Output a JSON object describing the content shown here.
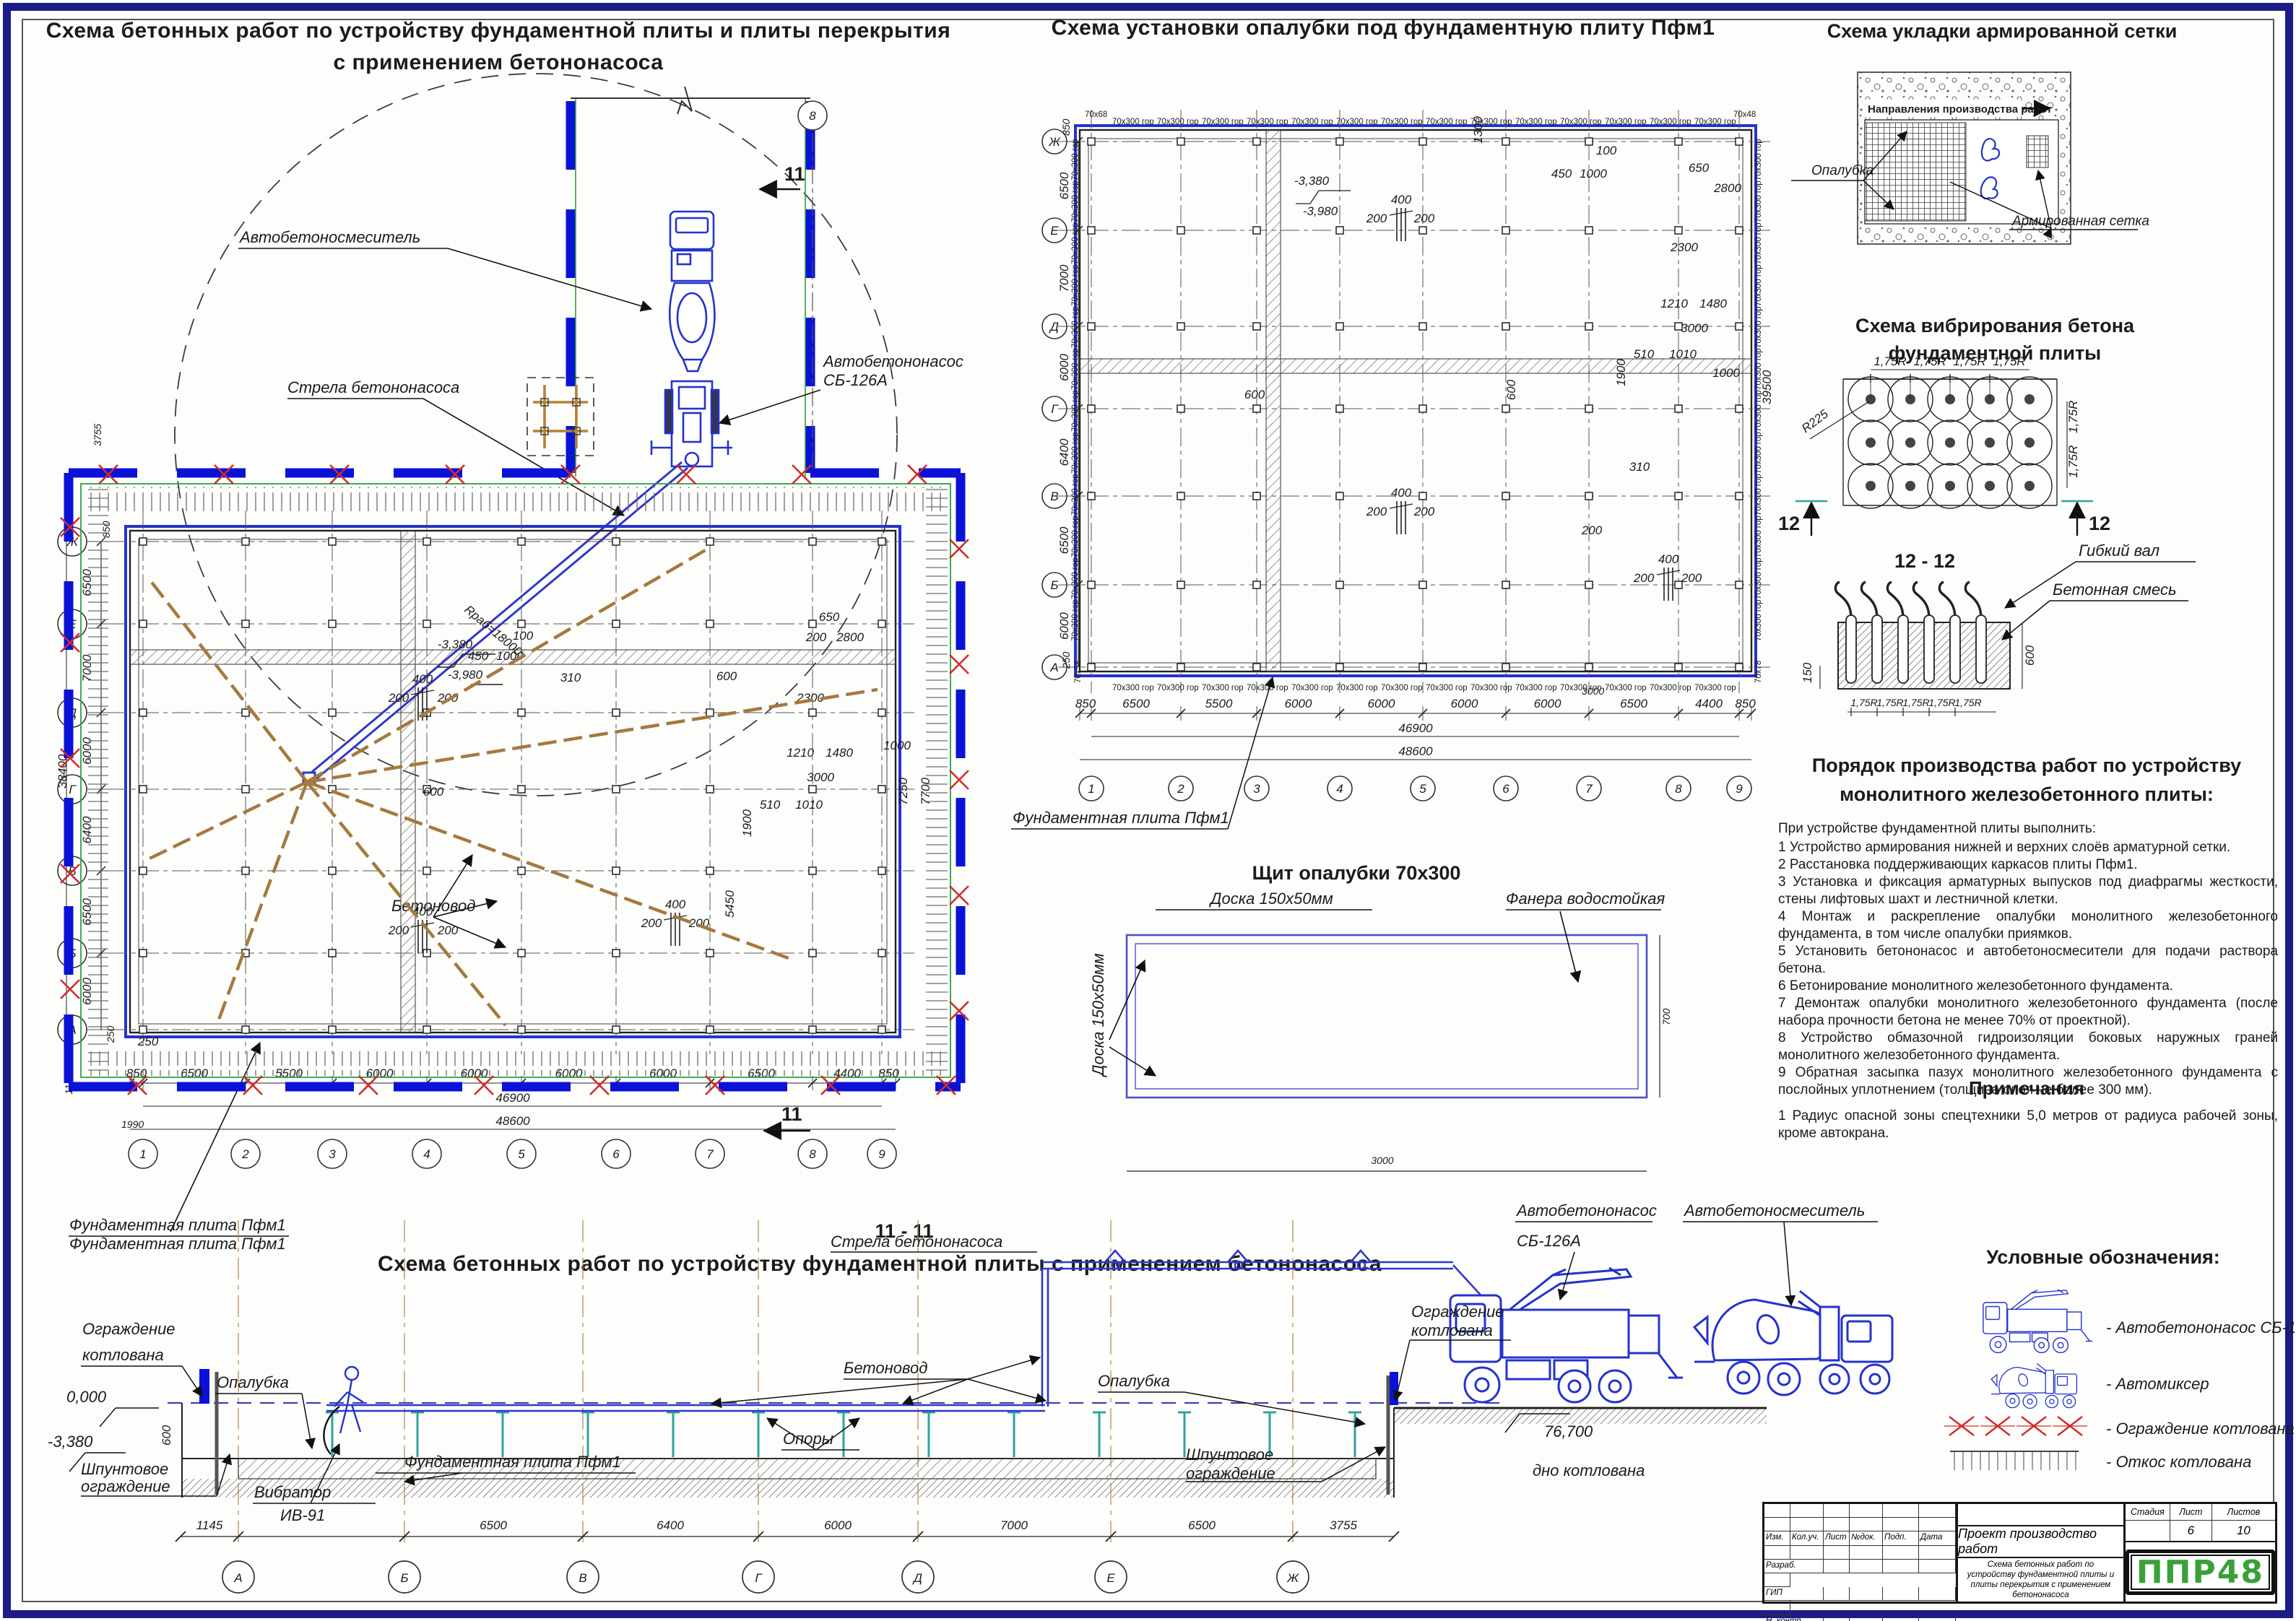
{
  "colors": {
    "cad_blue": "#2433cc",
    "bright_blue": "#0a12d8",
    "red": "#cf2c2c",
    "green": "#2f9e44",
    "tan": "#a5793f",
    "teal": "#2fa3a0",
    "logo_green": "#3aa13a",
    "frame_navy": "#1c1c86"
  },
  "main_plan": {
    "title1": "Схема бетонных работ по устройству фундаментной плиты и плиты перекрытия",
    "title2": "с применением бетононасоса",
    "labels": {
      "mixer": "Автобетоносмеситель",
      "pump1": "Автобетононасос",
      "pump2": "СБ-126А",
      "boom": "Стрела бетононасоса",
      "pipeline": "Бетоновод",
      "slab": "Фундаментная плита Пфм1",
      "radius": "Rраб=18000",
      "section": "11",
      "col8": "8"
    },
    "rows": [
      "Ж",
      "Е",
      "Д",
      "Г",
      "В",
      "Б",
      "А"
    ],
    "cols": [
      "1",
      "2",
      "3",
      "4",
      "5",
      "6",
      "7",
      "8",
      "9"
    ],
    "left_span_dims": [
      "6500",
      "7000",
      "6000",
      "6400",
      "6500",
      "6000"
    ],
    "left_extra": {
      "d850": "850",
      "d3755": "3755",
      "total": "38400",
      "d250": "250",
      "d1145": "1145",
      "d1990": "1990"
    },
    "bottom_dims": [
      "850",
      "6500",
      "5500",
      "6000",
      "6000",
      "6000",
      "6000",
      "6500",
      "4400",
      "850"
    ],
    "total1": "46900",
    "total2": "48600",
    "inner_dims": [
      "400",
      "200",
      "200",
      "400",
      "200",
      "200",
      "400",
      "200",
      "200",
      "450",
      "1000",
      "100",
      "310",
      "-3,380",
      "-3,980",
      "600",
      "600",
      "650",
      "200",
      "2800",
      "2300",
      "1210",
      "1480",
      "3000",
      "510",
      "1010",
      "1900",
      "7250",
      "7700",
      "1000",
      "5450",
      "250"
    ]
  },
  "formwork_plan": {
    "title": "Схема установки опалубки под фундаментную плиту Пфм1",
    "edge_label": "70х300 гор",
    "corner_tl": "70х68",
    "corner_tr": "70х48",
    "corner_bl": "70х58",
    "corner_br": "70х78",
    "rows": [
      "Ж",
      "Е",
      "Д",
      "Г",
      "В",
      "Б",
      "А"
    ],
    "cols": [
      "1",
      "2",
      "3",
      "4",
      "5",
      "6",
      "7",
      "8",
      "9"
    ],
    "left_span_dims": [
      "6500",
      "7000",
      "6000",
      "6400",
      "6500",
      "6000"
    ],
    "right_total": "39500",
    "left_850": "850",
    "left_250": "250",
    "bottom_dims": [
      "850",
      "6500",
      "5500",
      "6000",
      "6000",
      "6000",
      "6000",
      "6500",
      "4400",
      "850"
    ],
    "total1": "46900",
    "total2": "48600",
    "d3000": "3000",
    "slab_label": "Фундаментная плита Пфм1",
    "inner_dims": [
      "400",
      "200",
      "200",
      "400",
      "200",
      "200",
      "400",
      "200",
      "200",
      "450",
      "1000",
      "100",
      "310",
      "1300",
      "-3,380",
      "-3,980",
      "600",
      "600",
      "650",
      "2800",
      "2300",
      "1210",
      "1480",
      "3000",
      "510",
      "1010",
      "1900",
      "1000",
      "200"
    ]
  },
  "panel_detail": {
    "title": "Щит опалубки 70х300",
    "board_top": "Доска 150х50мм",
    "plywood": "Фанера водостойкая",
    "board_left": "Доска 150х50мм",
    "cell": "375",
    "total": "3000",
    "height": "700"
  },
  "mesh_scheme": {
    "title": "Схема укладки армированной сетки",
    "direction": "Направления производства работ",
    "formwork": "Опалубка",
    "mesh": "Армированная сетка"
  },
  "vibration_scheme": {
    "title1": "Схема вибрирования бетона",
    "title2": "фундаментной плиты",
    "step": "1,75R",
    "radius": "R225",
    "section": "12"
  },
  "section12": {
    "title": "12 - 12",
    "flex_shaft": "Гибкий вал",
    "mix": "Бетонная смесь",
    "d150": "150",
    "d600": "600",
    "step": "1,75R"
  },
  "work_order": {
    "title1": "Порядок производства работ по устройству",
    "title2": "монолитного железобетонного плиты:",
    "intro": "При устройстве фундаментной плиты выполнить:",
    "items": [
      "1 Устройство армирования нижней и верхних слоёв арматурной сетки.",
      "2 Расстановка поддерживающих каркасов плиты Пфм1.",
      "3 Установка и фиксация арматурных выпусков под диафрагмы жесткости, стены лифтовых шахт и лестничной клетки.",
      "4 Монтаж и раскрепление опалубки монолитного железобетонного фундамента, в том числе опалубки приямков.",
      "5 Установить бетононасос и автобетоносмесители для подачи раствора бетона.",
      "6 Бетонирование монолитного железобетонного фундамента.",
      "7 Демонтаж опалубки монолитного железобетонного фундамента (после набора прочности бетона не менее 70% от проектной).",
      "8 Устройство обмазочной гидроизоляции боковых наружных граней монолитного железобетонного фундамента.",
      "9 Обратная засыпка пазух монолитного железобетонного фундамента с послойных уплотнением (толщина слоя не более 300 мм)."
    ]
  },
  "notes": {
    "title": "Примечания",
    "item1": "1 Радиус опасной зоны спецтехники 5,0 метров от радиуса рабочей зоны, кроме автокрана."
  },
  "legend": {
    "title": "Условные обозначения:",
    "items": [
      {
        "name": "pump-truck",
        "label": "- Автобетононасос СБ-126А"
      },
      {
        "name": "mixer-truck",
        "label": "- Автомиксер"
      },
      {
        "name": "pit-fence",
        "label": "- Ограждение котлована"
      },
      {
        "name": "pit-slope",
        "label": "- Откос котлована"
      }
    ]
  },
  "section11": {
    "title": "11 - 11",
    "subtitle": "Схема бетонных работ по устройству фундаментной плиты с применением бетононасоса",
    "labels": {
      "slab_top": "Фундаментная плита Пфм1",
      "fence1": "Ограждение",
      "fence2": "котлована",
      "level0": "0,000",
      "level338": "-3,380",
      "h600": "600",
      "formwork": "Опалубка",
      "pipeline": "Бетоновод",
      "boom": "Стрела бетононасоса",
      "sheet1": "Шпунтовое",
      "sheet2": "ограждение",
      "vibr1": "Вибратор",
      "vibr2": "ИВ-91",
      "slab": "Фундаментная плита Пфм1",
      "supports": "Опоры",
      "pump1": "Автобетононасос",
      "pump2": "СБ-126А",
      "mixer": "Автобетоносмеситель",
      "bottom_level": "76,700",
      "bottom_label": "дно котлована"
    },
    "dims": [
      "1145",
      "6500",
      "6400",
      "6000",
      "7000",
      "6500",
      "3755"
    ],
    "grid": [
      "А",
      "Б",
      "В",
      "Г",
      "Д",
      "Е",
      "Ж"
    ]
  },
  "title_block": {
    "cols": [
      "Изм.",
      "Кол.уч.",
      "Лист",
      "№док.",
      "Подп.",
      "Дата"
    ],
    "rows": [
      "Разраб.",
      "ГИП",
      "Н. контр."
    ],
    "project": "Проект производство работ",
    "doc_title": "Схема бетонных работ по устройству фундаментной плиты и плиты перекрытия с применением бетононасоса",
    "stage_h": "Стадия",
    "sheet_h": "Лист",
    "sheets_h": "Листов",
    "sheet": "6",
    "sheets": "10",
    "logo": "ППР48"
  }
}
